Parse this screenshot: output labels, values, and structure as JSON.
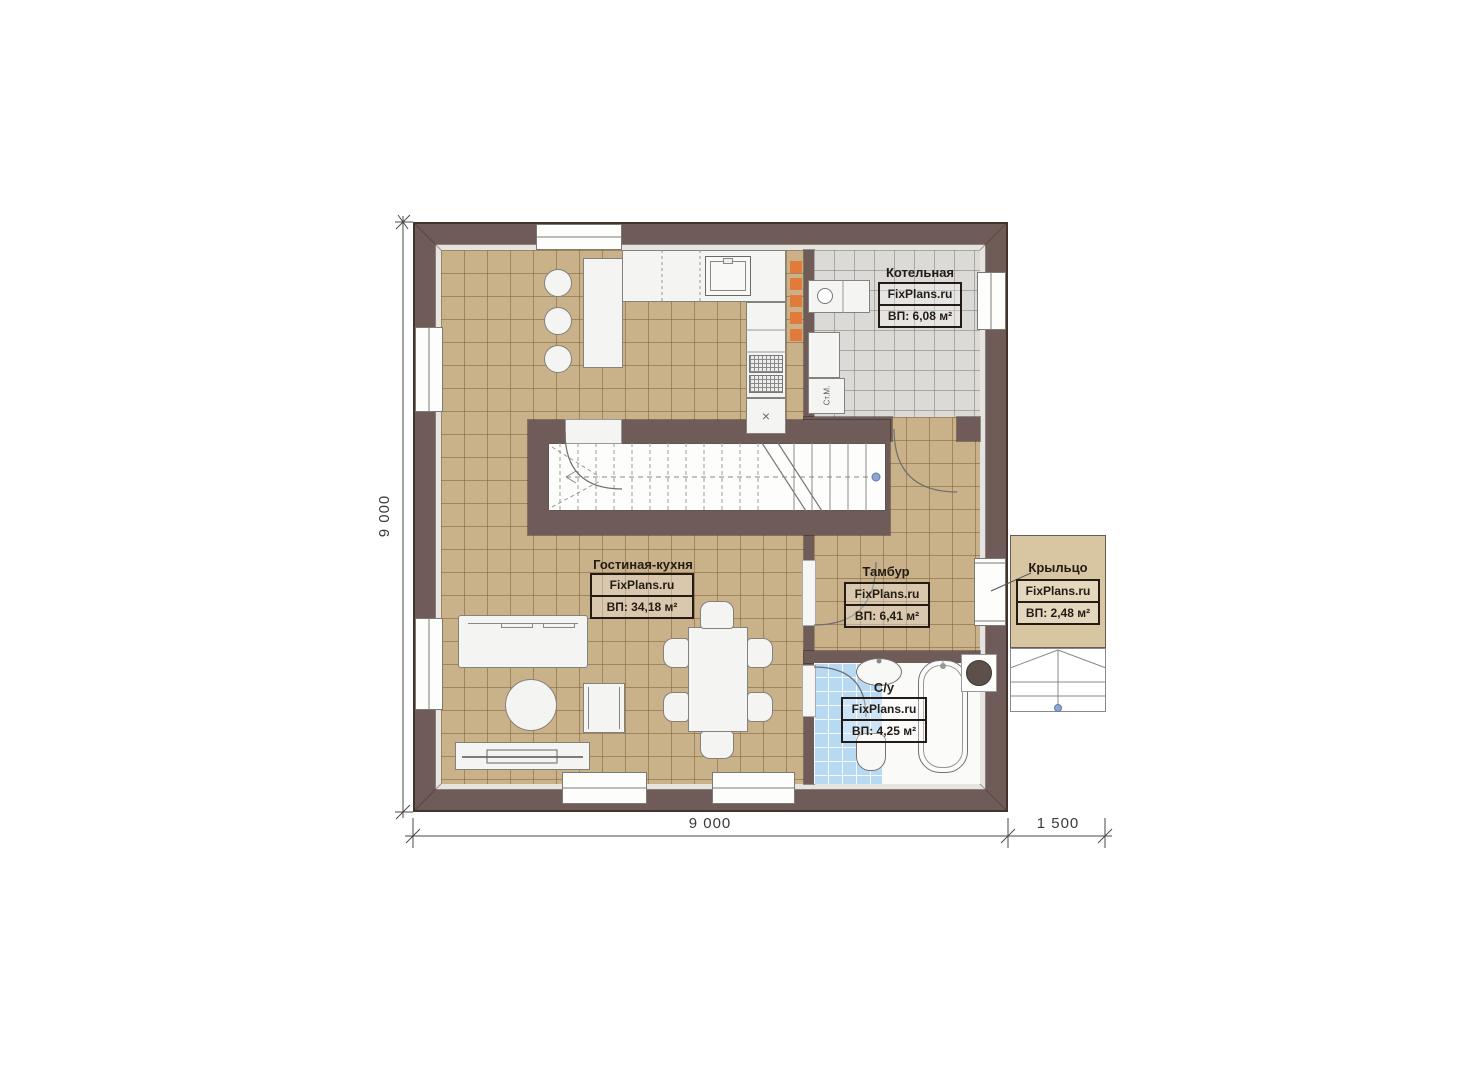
{
  "plan": {
    "rooms": [
      {
        "name": "Котельная",
        "brand": "FixPlans.ru",
        "area": "ВП: 6,08 м²"
      },
      {
        "name": "Гостиная-кухня",
        "brand": "FixPlans.ru",
        "area": "ВП: 34,18 м²"
      },
      {
        "name": "Тамбур",
        "brand": "FixPlans.ru",
        "area": "ВП: 6,41 м²"
      },
      {
        "name": "С/у",
        "brand": "FixPlans.ru",
        "area": "ВП: 4,25 м²"
      },
      {
        "name": "Крыльцо",
        "brand": "FixPlans.ru",
        "area": "ВП: 2,48 м²"
      }
    ],
    "appliances": {
      "washing_machine": "Ст.М."
    },
    "symbols": {
      "hood": "×"
    },
    "dimensions": {
      "height": "9 000",
      "width": "9 000",
      "porch": "1 500"
    },
    "colors": {
      "wall": "#6f5b58",
      "floor_tan": "#c9b18a",
      "floor_gray": "#dbdad7",
      "floor_blue": "#b7d9f2",
      "porch": "#d8c6a3",
      "accent_orange": "#e07b39"
    }
  }
}
